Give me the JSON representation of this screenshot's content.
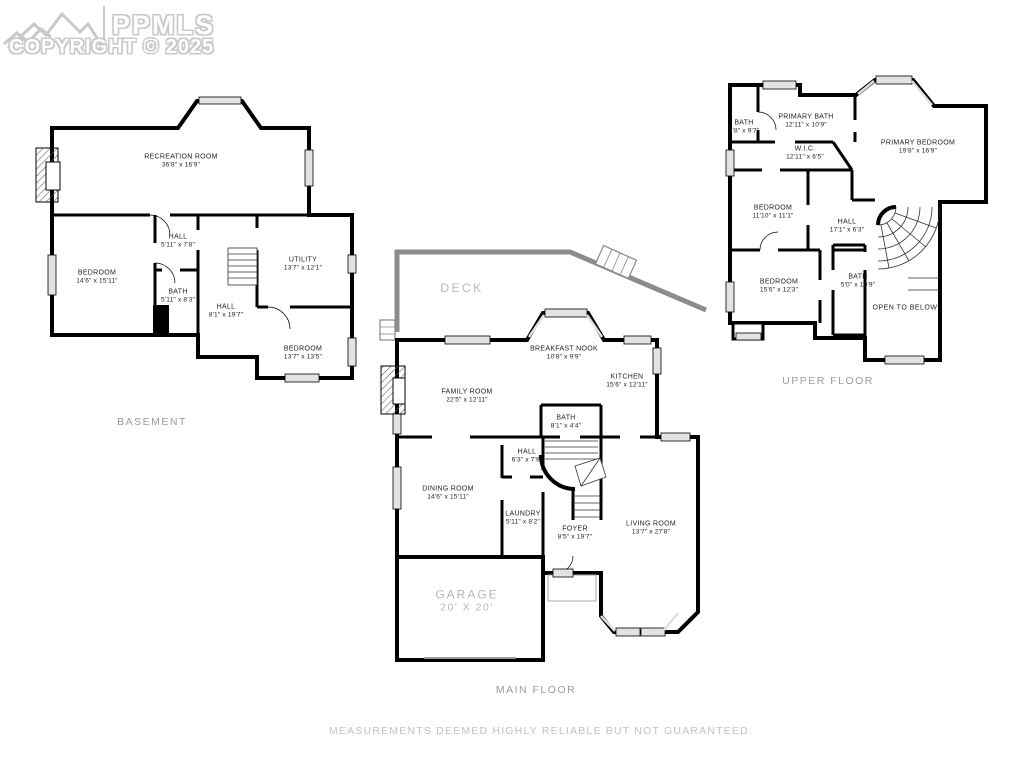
{
  "logo": {
    "brand": "PPMLS",
    "copyright": "COPYRIGHT © 2025",
    "icon": "mountain-icon"
  },
  "footer": {
    "disclaimer": "MEASUREMENTS DEEMED HIGHLY RELIABLE BUT NOT GUARANTEED."
  },
  "floors": {
    "basement": {
      "title": "BASEMENT",
      "rooms": [
        {
          "name": "RECREATION ROOM",
          "dims": "36'8\" x 16'9\""
        },
        {
          "name": "HALL",
          "dims": "5'11\" x 7'8\""
        },
        {
          "name": "BEDROOM",
          "dims": "14'6\" x 15'11\""
        },
        {
          "name": "BATH",
          "dims": "5'11\" x 8'3\""
        },
        {
          "name": "HALL",
          "dims": "8'1\" x 19'7\""
        },
        {
          "name": "UTILITY",
          "dims": "13'7\" x 12'1\""
        },
        {
          "name": "BEDROOM",
          "dims": "13'7\" x 13'5\""
        }
      ]
    },
    "main": {
      "title": "MAIN FLOOR",
      "rooms": [
        {
          "name": "DECK",
          "dims": ""
        },
        {
          "name": "BREAKFAST NOOK",
          "dims": "10'8\" x 9'9\""
        },
        {
          "name": "FAMILY ROOM",
          "dims": "22'5\" x 12'11\""
        },
        {
          "name": "KITCHEN",
          "dims": "15'6\" x 12'11\""
        },
        {
          "name": "BATH",
          "dims": "8'1\" x 4'4\""
        },
        {
          "name": "HALL",
          "dims": "6'3\" x 7'9\""
        },
        {
          "name": "DINING ROOM",
          "dims": "14'6\" x 15'11\""
        },
        {
          "name": "LAUNDRY",
          "dims": "5'11\" x 8'2\""
        },
        {
          "name": "FOYER",
          "dims": "8'5\" x 19'7\""
        },
        {
          "name": "LIVING ROOM",
          "dims": "13'7\" x 27'8\""
        },
        {
          "name": "GARAGE",
          "dims": "20' X 20'"
        }
      ]
    },
    "upper": {
      "title": "UPPER FLOOR",
      "rooms": [
        {
          "name": "BATH",
          "dims": "3'8\" x 9'7\""
        },
        {
          "name": "PRIMARY BATH",
          "dims": "12'11\" x 10'9\""
        },
        {
          "name": "W.I.C.",
          "dims": "12'11\" x 6'5\""
        },
        {
          "name": "PRIMARY BEDROOM",
          "dims": "19'8\" x 16'9\""
        },
        {
          "name": "BEDROOM",
          "dims": "11'10\" x 11'1\""
        },
        {
          "name": "HALL",
          "dims": "17'1\" x 6'3\""
        },
        {
          "name": "BEDROOM",
          "dims": "15'6\" x 12'3\""
        },
        {
          "name": "BATH",
          "dims": "5'0\" x 10'9\""
        },
        {
          "name": "OPEN TO BELOW",
          "dims": ""
        }
      ]
    }
  }
}
